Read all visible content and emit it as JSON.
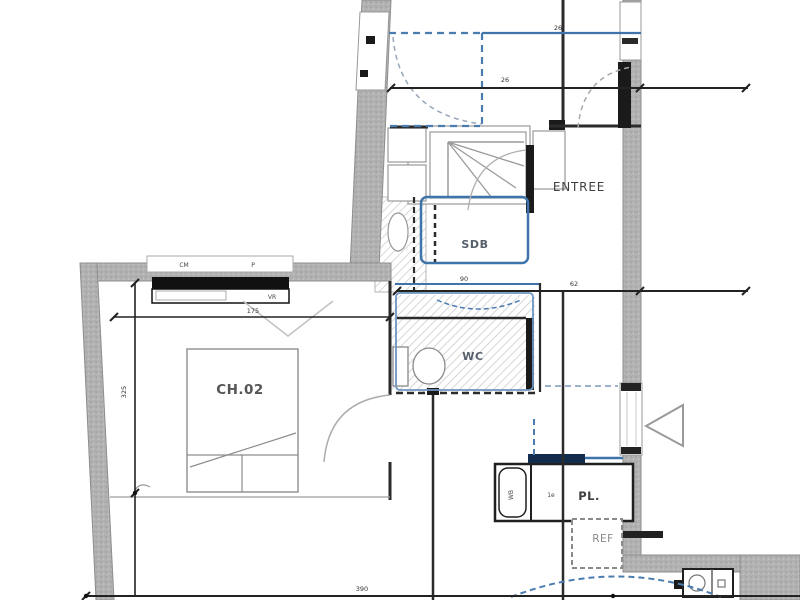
{
  "rooms": {
    "entree": "ENTREE",
    "sdb": "SDB",
    "wc": "WC",
    "ch02": "CH.02",
    "pl": "PL.",
    "ref": "REF"
  },
  "window": {
    "tag_left": "CM",
    "tag_right": "P",
    "shutter": "VR"
  },
  "dims": {
    "entry_blue": "26",
    "entry_black": "26",
    "hall": "62",
    "sdb": "90",
    "window_width": "175",
    "bottom": "390",
    "left_height": "325"
  },
  "pl_tags": {
    "cell": "1e",
    "heater": "WB"
  },
  "colors": {
    "wall": "#b2b2b2",
    "line": "#2b2b2b",
    "blue": "#3f74ab",
    "blue_dash": "#4a7cb0",
    "navy": "#122c4e",
    "label": "#4a4a4a"
  }
}
